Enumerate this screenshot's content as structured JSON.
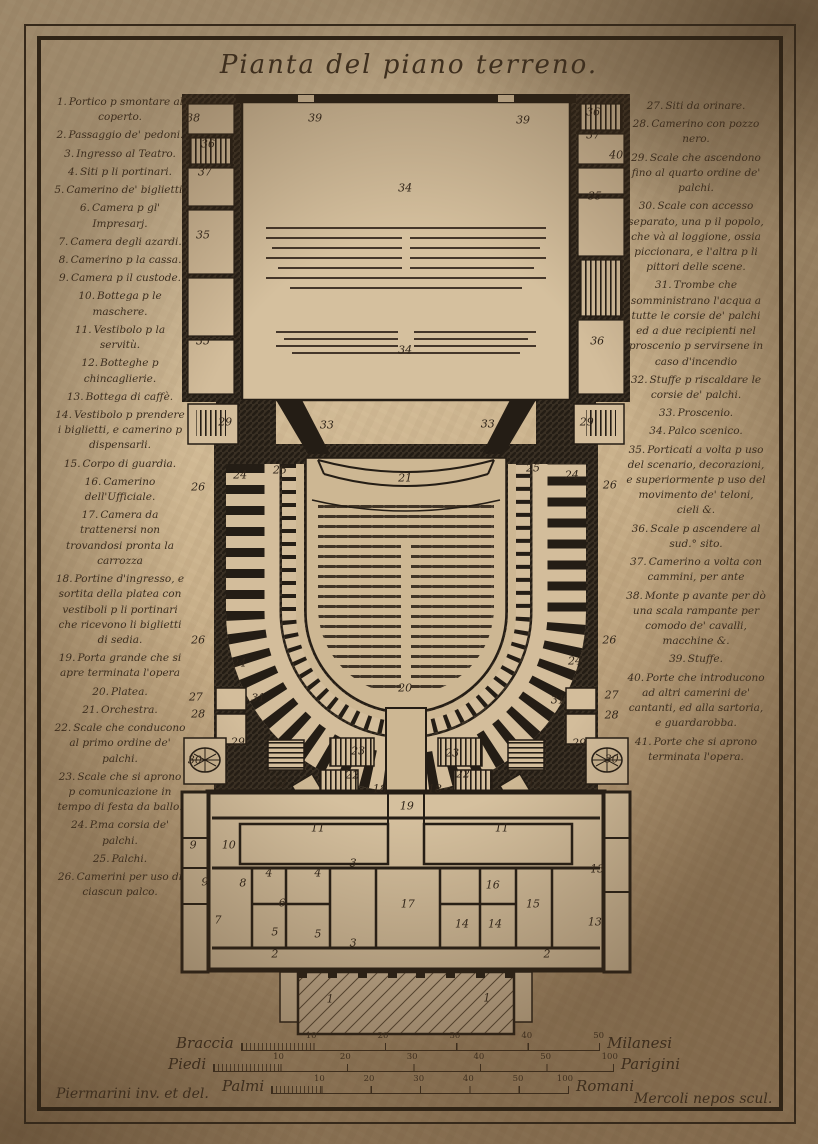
{
  "title": "Pianta del piano terreno.",
  "legend_left": [
    {
      "n": "1.",
      "t": "Portico p smontare al coperto."
    },
    {
      "n": "2.",
      "t": "Passaggio de' pedoni."
    },
    {
      "n": "3.",
      "t": "Ingresso al Teatro."
    },
    {
      "n": "4.",
      "t": "Siti p li portinari."
    },
    {
      "n": "5.",
      "t": "Camerino de' biglietti."
    },
    {
      "n": "6.",
      "t": "Camera p gl' Impresarj."
    },
    {
      "n": "7.",
      "t": "Camera degli azardi."
    },
    {
      "n": "8.",
      "t": "Camerino p la cassa."
    },
    {
      "n": "9.",
      "t": "Camera p il custode."
    },
    {
      "n": "10.",
      "t": "Bottega p le maschere."
    },
    {
      "n": "11.",
      "t": "Vestibolo p la servitù."
    },
    {
      "n": "12.",
      "t": "Botteghe p chincaglierie."
    },
    {
      "n": "13.",
      "t": "Bottega di caffè."
    },
    {
      "n": "14.",
      "t": "Vestibolo p prendere i biglietti, e camerino p dispensarli."
    },
    {
      "n": "15.",
      "t": "Corpo di guardia."
    },
    {
      "n": "16.",
      "t": "Camerino dell'Ufficiale."
    },
    {
      "n": "17.",
      "t": "Camera da trattenersi non trovandosi pronta la carrozza"
    },
    {
      "n": "18.",
      "t": "Portine d'ingresso, e sortita della platea con vestiboli p li portinari che ricevono li biglietti di sedia."
    },
    {
      "n": "19.",
      "t": "Porta grande che si apre terminata l'opera"
    },
    {
      "n": "20.",
      "t": "Platea."
    },
    {
      "n": "21.",
      "t": "Orchestra."
    },
    {
      "n": "22.",
      "t": "Scale che conducono al primo ordine de' palchi."
    },
    {
      "n": "23.",
      "t": "Scale che si aprono p comunicazione in tempo di festa da ballo."
    },
    {
      "n": "24.",
      "t": "P.ma corsia de' palchi."
    },
    {
      "n": "25.",
      "t": "Palchi."
    },
    {
      "n": "26.",
      "t": "Camerini per uso di ciascun palco."
    }
  ],
  "legend_right": [
    {
      "n": "27.",
      "t": "Siti da orinare."
    },
    {
      "n": "28.",
      "t": "Camerino con pozzo nero."
    },
    {
      "n": "29.",
      "t": "Scale che ascendono fino al quarto ordine de' palchi."
    },
    {
      "n": "30.",
      "t": "Scale con accesso separato, una p il popolo, che và al loggione, ossia piccionara, e l'altra p li pittori delle scene."
    },
    {
      "n": "31.",
      "t": "Trombe che somministrano l'acqua a tutte le corsie de' palchi ed a due recipienti nel proscenio p servirsene in caso d'incendio"
    },
    {
      "n": "32.",
      "t": "Stuffe p riscaldare le corsie de' palchi."
    },
    {
      "n": "33.",
      "t": "Proscenio."
    },
    {
      "n": "34.",
      "t": "Palco scenico."
    },
    {
      "n": "35.",
      "t": "Porticati a volta p uso del scenario, decorazioni, e superiormente p uso del movimento de' teloni, cieli &."
    },
    {
      "n": "36.",
      "t": "Scale p ascendere al sud.° sito."
    },
    {
      "n": "37.",
      "t": "Camerino a volta con cammini, per ante"
    },
    {
      "n": "38.",
      "t": "Monte p avante per dò una scala rampante per comodo de' cavalli, macchine &."
    },
    {
      "n": "39.",
      "t": "Stuffe."
    },
    {
      "n": "40.",
      "t": "Porte che introducono ad altri camerini de' cantanti, ed alla sartoria, e guardarobba."
    },
    {
      "n": "41.",
      "t": "Porte che si aprono terminata l'opera."
    }
  ],
  "plan": {
    "labels": [
      {
        "text": "38",
        "x": 2.9,
        "y": 2.8
      },
      {
        "text": "36",
        "x": 6.2,
        "y": 5.5
      },
      {
        "text": "37",
        "x": 5.5,
        "y": 8.5
      },
      {
        "text": "35",
        "x": 5.1,
        "y": 15.1
      },
      {
        "text": "35",
        "x": 5.1,
        "y": 26.3
      },
      {
        "text": "39",
        "x": 29.9,
        "y": 2.8
      },
      {
        "text": "39",
        "x": 75.9,
        "y": 3.0
      },
      {
        "text": "34",
        "x": 49.8,
        "y": 10.2
      },
      {
        "text": "34",
        "x": 49.8,
        "y": 27.3
      },
      {
        "text": "36",
        "x": 91.4,
        "y": 2.1
      },
      {
        "text": "37",
        "x": 91.4,
        "y": 4.6
      },
      {
        "text": "40",
        "x": 96.5,
        "y": 6.7
      },
      {
        "text": "35",
        "x": 91.8,
        "y": 11.0
      },
      {
        "text": "36",
        "x": 92.3,
        "y": 26.3
      },
      {
        "text": "33",
        "x": 32.5,
        "y": 35.2
      },
      {
        "text": "33",
        "x": 68.1,
        "y": 35.1
      },
      {
        "text": "29",
        "x": 10.0,
        "y": 34.9
      },
      {
        "text": "29",
        "x": 90.0,
        "y": 34.9
      },
      {
        "text": "21",
        "x": 49.8,
        "y": 40.8
      },
      {
        "text": "25",
        "x": 22.1,
        "y": 40.0
      },
      {
        "text": "24",
        "x": 13.3,
        "y": 40.5
      },
      {
        "text": "26",
        "x": 4.0,
        "y": 41.8
      },
      {
        "text": "25",
        "x": 78.1,
        "y": 39.8
      },
      {
        "text": "24",
        "x": 86.7,
        "y": 40.5
      },
      {
        "text": "26",
        "x": 95.1,
        "y": 41.6
      },
      {
        "text": "26",
        "x": 4.0,
        "y": 58.0
      },
      {
        "text": "24",
        "x": 13.1,
        "y": 60.4
      },
      {
        "text": "26",
        "x": 95.0,
        "y": 58.0
      },
      {
        "text": "24",
        "x": 87.4,
        "y": 60.2
      },
      {
        "text": "20",
        "x": 49.8,
        "y": 63.1
      },
      {
        "text": "31",
        "x": 17.3,
        "y": 64.1
      },
      {
        "text": "31",
        "x": 83.6,
        "y": 64.3
      },
      {
        "text": "27",
        "x": 3.5,
        "y": 64.0
      },
      {
        "text": "28",
        "x": 4.0,
        "y": 65.8
      },
      {
        "text": "29",
        "x": 12.8,
        "y": 68.8
      },
      {
        "text": "30",
        "x": 3.3,
        "y": 70.7
      },
      {
        "text": "27",
        "x": 95.5,
        "y": 63.8
      },
      {
        "text": "28",
        "x": 95.5,
        "y": 65.9
      },
      {
        "text": "29",
        "x": 88.3,
        "y": 68.9
      },
      {
        "text": "30",
        "x": 95.5,
        "y": 70.6
      },
      {
        "text": "23",
        "x": 39.4,
        "y": 69.7
      },
      {
        "text": "23",
        "x": 60.2,
        "y": 69.9
      },
      {
        "text": "22",
        "x": 38.1,
        "y": 72.3
      },
      {
        "text": "22",
        "x": 62.6,
        "y": 72.2
      },
      {
        "text": "18",
        "x": 44.2,
        "y": 73.8
      },
      {
        "text": "18",
        "x": 56.4,
        "y": 73.8
      },
      {
        "text": "19",
        "x": 50.2,
        "y": 75.6
      },
      {
        "text": "12",
        "x": 22.1,
        "y": 73.1
      },
      {
        "text": "12",
        "x": 78.5,
        "y": 73.1
      },
      {
        "text": "11",
        "x": 30.5,
        "y": 77.9
      },
      {
        "text": "11",
        "x": 71.2,
        "y": 77.9
      },
      {
        "text": "9",
        "x": 2.9,
        "y": 79.7
      },
      {
        "text": "10",
        "x": 10.8,
        "y": 79.7
      },
      {
        "text": "9",
        "x": 5.5,
        "y": 83.6
      },
      {
        "text": "8",
        "x": 13.9,
        "y": 83.7
      },
      {
        "text": "7",
        "x": 8.4,
        "y": 87.6
      },
      {
        "text": "6",
        "x": 22.6,
        "y": 85.8
      },
      {
        "text": "4",
        "x": 19.7,
        "y": 82.6
      },
      {
        "text": "4",
        "x": 30.5,
        "y": 82.6
      },
      {
        "text": "3",
        "x": 38.3,
        "y": 81.6
      },
      {
        "text": "3",
        "x": 38.3,
        "y": 90.0
      },
      {
        "text": "5",
        "x": 21.0,
        "y": 88.9
      },
      {
        "text": "5",
        "x": 30.5,
        "y": 89.1
      },
      {
        "text": "17",
        "x": 50.4,
        "y": 85.9
      },
      {
        "text": "16",
        "x": 69.2,
        "y": 83.9
      },
      {
        "text": "14",
        "x": 62.4,
        "y": 88.0
      },
      {
        "text": "14",
        "x": 69.7,
        "y": 88.0
      },
      {
        "text": "15",
        "x": 78.1,
        "y": 85.9
      },
      {
        "text": "13",
        "x": 92.3,
        "y": 82.2
      },
      {
        "text": "13",
        "x": 91.8,
        "y": 87.8
      },
      {
        "text": "2",
        "x": 21.0,
        "y": 91.2
      },
      {
        "text": "2",
        "x": 81.2,
        "y": 91.2
      },
      {
        "text": "1",
        "x": 33.2,
        "y": 96.0
      },
      {
        "text": "1",
        "x": 67.9,
        "y": 95.9
      }
    ]
  },
  "scales": {
    "braccia": {
      "name": "Braccia",
      "unit": "Milanesi",
      "ticks": [
        "10",
        "20",
        "30",
        "40",
        "50"
      ]
    },
    "piedi": {
      "name": "Piedi",
      "unit": "Parigini",
      "ticks": [
        "10",
        "20",
        "30",
        "40",
        "50",
        "100"
      ]
    },
    "palmi": {
      "name": "Palmi",
      "unit": "Romani",
      "ticks": [
        "10",
        "20",
        "30",
        "40",
        "50",
        "100"
      ]
    }
  },
  "credits": {
    "left": "Piermarini inv. et del.",
    "right": "Mercoli nepos scul."
  },
  "colors": {
    "paper": "#c9b292",
    "ink": "#3a2d1f",
    "wall": "#241d15",
    "room": "#d5c09e"
  }
}
